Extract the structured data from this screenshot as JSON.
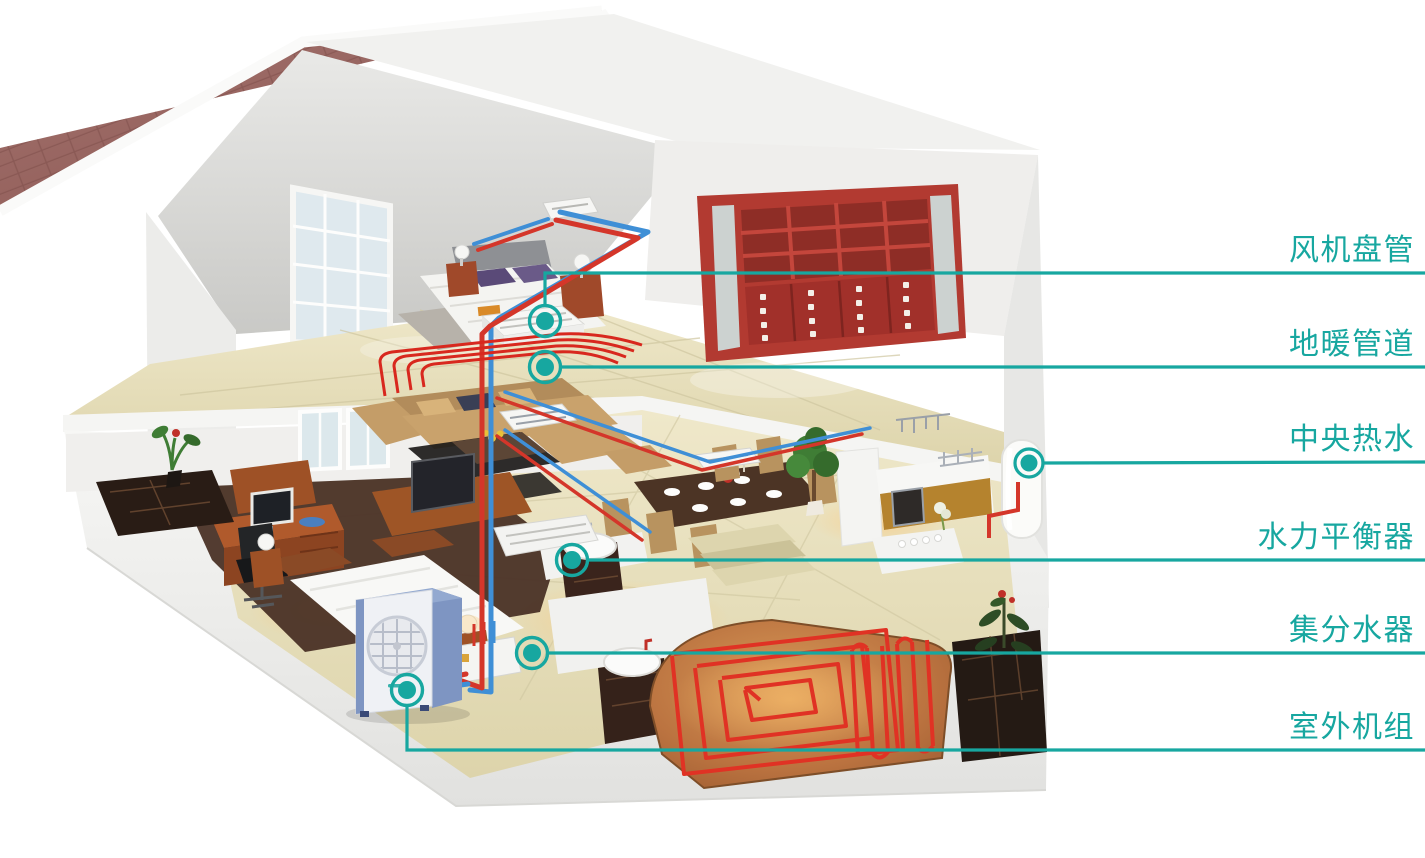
{
  "callouts": [
    {
      "id": "fan-coil",
      "label": "风机盘管"
    },
    {
      "id": "floor-heating",
      "label": "地暖管道"
    },
    {
      "id": "central-hot-water",
      "label": "中央热水"
    },
    {
      "id": "hydraulic-balancer",
      "label": "水力平衡器"
    },
    {
      "id": "manifold",
      "label": "集分水器"
    },
    {
      "id": "outdoor-unit",
      "label": "室外机组"
    }
  ],
  "colors": {
    "callout_teal": "#17a7a0",
    "pipe_hot_red": "#d4362a",
    "pipe_cold_blue": "#3f8fd6",
    "roof_maroon": "#96625e",
    "floor_cream": "#e9e2c0",
    "bookshelf_red": "#b23a31",
    "outdoor_unit_blue": "#7e95c2",
    "heating_coil_red": "#e03224"
  },
  "scene": {
    "elements": [
      "house-cutaway",
      "gable-roof",
      "attic-bedroom",
      "bed",
      "nightstand-lamps",
      "red-bookshelf",
      "living-room-sofa",
      "coffee-table",
      "tv-cabinet",
      "dining-table",
      "kitchen-counters",
      "kitchen-island",
      "bathroom-sinks",
      "toilet",
      "floor-heating-spiral",
      "hot-water-tank",
      "outdoor-heat-pump-unit",
      "hot-cold-pipes",
      "fan-coil-units",
      "manifold-unit",
      "potted-plants",
      "marble-planters"
    ]
  }
}
